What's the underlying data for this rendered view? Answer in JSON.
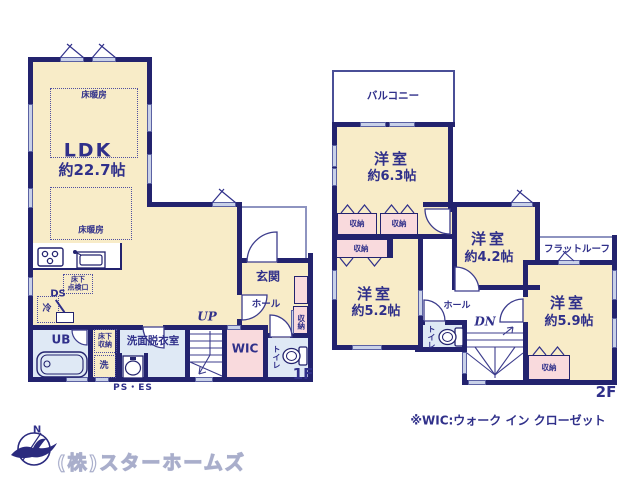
{
  "f1": {
    "floor_label": "1F",
    "ldk_name": "LDK",
    "ldk_size": "約22.7帖",
    "floor_heating": "床暖房",
    "hatch_l1": "床下",
    "hatch_l2": "点検口",
    "ds": "DS",
    "fridge": "冷",
    "ub": "UB",
    "underfloor_l1": "床下",
    "underfloor_l2": "収納",
    "washer": "洗",
    "washroom": "洗面脱衣室",
    "ps_es": "PS・ES",
    "up": "UP",
    "wic": "WIC",
    "toilet": "トイレ",
    "genkan": "玄関",
    "hall": "ホール",
    "storage": "収納"
  },
  "f2": {
    "floor_label": "2F",
    "balcony": "バルコニー",
    "room63_name": "洋室",
    "room63_size": "約6.3帖",
    "room42_name": "洋室",
    "room42_size": "約4.2帖",
    "room52_name": "洋室",
    "room52_size": "約5.2帖",
    "room59_name": "洋室",
    "room59_size": "約5.9帖",
    "flat_roof": "フラットルーフ",
    "hall": "ホール",
    "dn": "DN",
    "toilet": "トイレ",
    "storage": "収納"
  },
  "footer": {
    "wic_note": "※WIC:ウォーク イン クローゼット",
    "company": "(株)スターホームズ",
    "compass_n": "N"
  },
  "colors": {
    "wall": "#23236e",
    "text": "#30308a",
    "room_cream": "#f8ecc8",
    "storage_pink": "#f9dadd",
    "wet_blue": "#dfe9f5",
    "window": "#c9d1e8"
  }
}
